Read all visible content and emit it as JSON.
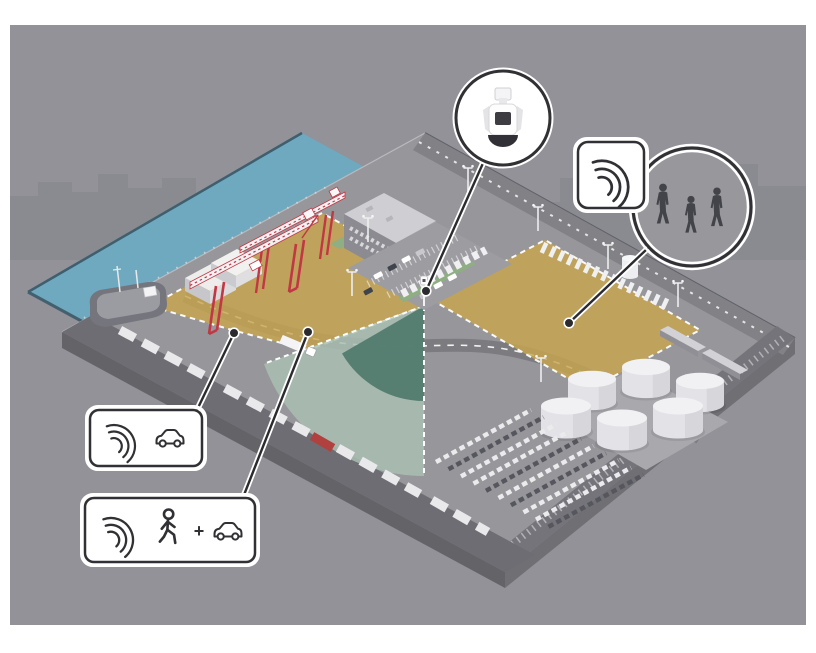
{
  "illustration": {
    "description": "Isometric port facility with radar-based detection zones",
    "background": "#929298",
    "colors": {
      "water": "#6FA9BF",
      "platform": "#96969B",
      "road_dark": "#6D6D73",
      "zone_yellow": "#C8A54E",
      "cone_dark": "#4F7A6C",
      "cone_light": "#AABFB2",
      "crane_red": "#C23743",
      "outline_dark": "#313135",
      "callout_fill": "#FFFFFF"
    },
    "callouts": {
      "device_closeup": {
        "icon": "radar-camera-device"
      },
      "people_closeup": {
        "icon": "radar-waves",
        "content": "three-person-silhouettes"
      },
      "vehicle_zone_label": {
        "icons": [
          "radar-waves",
          "car-outline"
        ]
      },
      "person_vehicle_zone_label": {
        "icons": [
          "radar-waves",
          "person-outline",
          "plus",
          "car-outline"
        ],
        "plus": "+"
      }
    },
    "scene_elements": [
      "city-skyline",
      "harbor-water",
      "cargo-ship",
      "container-cranes",
      "container-stacks",
      "office-building",
      "parking-lot",
      "van-row",
      "tanker-trailer-row",
      "storage-tanks",
      "vehicle-storage-rows",
      "freight-train",
      "truck-trailers-road",
      "radar-on-pole",
      "detection-cone",
      "detection-zone-left",
      "detection-zone-right",
      "roads"
    ]
  }
}
